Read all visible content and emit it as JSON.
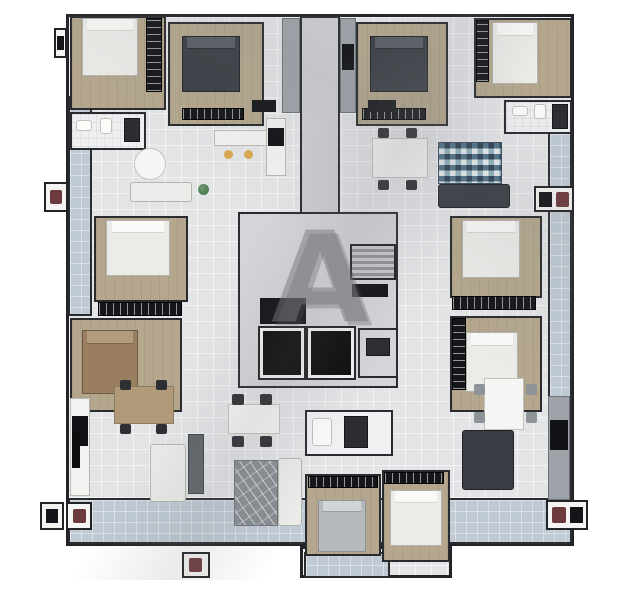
{
  "scene": {
    "type": "apartment-building-floor-plan-3d-render",
    "background": "#ffffff"
  },
  "watermark": {
    "letter": "A"
  },
  "palette": {
    "wall": "#232327",
    "tile_floor": "#e3e4e6",
    "wood_floor": "#b4a78d",
    "balcony_tile": "#bfcad4",
    "core_floor": "#d4d5d8",
    "dark_furniture": "#3c3f45",
    "mosaic_navy": "#2d4254",
    "mosaic_teal": "#8fb2bf",
    "accent_red": "#6c3a3d",
    "stool_yellow": "#d9a84e",
    "plant_green": "#4f7a52"
  },
  "floor_plan": {
    "width": 639,
    "height": 600,
    "elements": [
      {
        "n": "floor-plate",
        "t": "plate",
        "x": 66,
        "y": 14,
        "w": 508,
        "h": 532
      },
      {
        "n": "floor-plate-extension",
        "t": "plate",
        "x": 300,
        "y": 546,
        "w": 152,
        "h": 32
      },
      {
        "n": "balcony-left",
        "t": "balcony",
        "x": 68,
        "y": 96,
        "w": 24,
        "h": 220
      },
      {
        "n": "balcony-right",
        "t": "balcony",
        "x": 548,
        "y": 132,
        "w": 24,
        "h": 366
      },
      {
        "n": "balcony-bottom",
        "t": "balcony",
        "x": 68,
        "y": 498,
        "w": 504,
        "h": 46
      },
      {
        "n": "balcony-extension",
        "t": "balcony",
        "x": 304,
        "y": 552,
        "w": 86,
        "h": 26
      },
      {
        "n": "corridor-top",
        "t": "hallf",
        "x": 300,
        "y": 16,
        "w": 40,
        "h": 198
      },
      {
        "n": "core-floor",
        "t": "coref",
        "x": 238,
        "y": 212,
        "w": 160,
        "h": 176
      },
      {
        "n": "bedroom-top-left",
        "t": "wood",
        "x": 70,
        "y": 16,
        "w": 96,
        "h": 94
      },
      {
        "n": "bedroom-top-left-2",
        "t": "wood",
        "x": 168,
        "y": 22,
        "w": 96,
        "h": 104
      },
      {
        "n": "bedroom-top-center-right",
        "t": "wood",
        "x": 356,
        "y": 22,
        "w": 92,
        "h": 104
      },
      {
        "n": "bedroom-top-right",
        "t": "wood",
        "x": 474,
        "y": 18,
        "w": 98,
        "h": 80
      },
      {
        "n": "bedroom-mid-left-1",
        "t": "wood",
        "x": 94,
        "y": 216,
        "w": 94,
        "h": 86
      },
      {
        "n": "bedroom-mid-left-2",
        "t": "wood",
        "x": 70,
        "y": 318,
        "w": 112,
        "h": 94
      },
      {
        "n": "bedroom-mid-right-1",
        "t": "wood",
        "x": 450,
        "y": 216,
        "w": 92,
        "h": 82
      },
      {
        "n": "bedroom-mid-right-2",
        "t": "wood",
        "x": 450,
        "y": 316,
        "w": 92,
        "h": 96
      },
      {
        "n": "bedroom-bottom-center-1",
        "t": "wood",
        "x": 305,
        "y": 474,
        "w": 76,
        "h": 82
      },
      {
        "n": "bedroom-bottom-center-2",
        "t": "wood",
        "x": 382,
        "y": 470,
        "w": 68,
        "h": 92
      },
      {
        "n": "bathroom-top-left",
        "t": "bathf",
        "x": 70,
        "y": 112,
        "w": 76,
        "h": 38
      },
      {
        "n": "bathroom-top-right",
        "t": "bathf",
        "x": 504,
        "y": 100,
        "w": 68,
        "h": 34
      },
      {
        "n": "laundry-bottom-center",
        "t": "laundry",
        "x": 305,
        "y": 410,
        "w": 88,
        "h": 46
      },
      {
        "n": "kitchen-island-top-left",
        "t": "counter",
        "x": 214,
        "y": 130,
        "w": 54,
        "h": 16
      },
      {
        "n": "kitchen-counter-top-left",
        "t": "counter",
        "x": 266,
        "y": 118,
        "w": 20,
        "h": 58
      },
      {
        "n": "cooktop-top-left",
        "t": "black",
        "x": 268,
        "y": 128,
        "w": 16,
        "h": 18
      },
      {
        "n": "appliance-cabinet-left",
        "t": "cab",
        "x": 282,
        "y": 18,
        "w": 18,
        "h": 95
      },
      {
        "n": "appliance-cabinet-right",
        "t": "cab",
        "x": 340,
        "y": 18,
        "w": 16,
        "h": 95
      },
      {
        "n": "fridge-top-center",
        "t": "black",
        "x": 342,
        "y": 44,
        "w": 12,
        "h": 26
      },
      {
        "n": "kitchen-counter-bottom-left",
        "t": "counter",
        "x": 70,
        "y": 398,
        "w": 20,
        "h": 98
      },
      {
        "n": "cooktop-bottom-left",
        "t": "black",
        "x": 72,
        "y": 416,
        "w": 16,
        "h": 30
      },
      {
        "n": "kitchen-counter-bottom-center",
        "t": "counter-dark",
        "x": 188,
        "y": 434,
        "w": 16,
        "h": 60
      },
      {
        "n": "kitchen-counter-bottom-right",
        "t": "cab",
        "x": 548,
        "y": 396,
        "w": 22,
        "h": 104
      },
      {
        "n": "appliance-bottom-right",
        "t": "black",
        "x": 550,
        "y": 420,
        "w": 18,
        "h": 30
      },
      {
        "n": "wardrobe-top-left",
        "t": "wardrobe-v",
        "x": 146,
        "y": 18,
        "w": 16,
        "h": 74
      },
      {
        "n": "wardrobe-top-left-2",
        "t": "wardrobe",
        "x": 182,
        "y": 108,
        "w": 62,
        "h": 12
      },
      {
        "n": "wardrobe-top-center-right",
        "t": "wardrobe",
        "x": 362,
        "y": 108,
        "w": 64,
        "h": 12
      },
      {
        "n": "wardrobe-top-right",
        "t": "wardrobe-v",
        "x": 476,
        "y": 20,
        "w": 13,
        "h": 62
      },
      {
        "n": "wardrobe-mid-left",
        "t": "wardrobe",
        "x": 98,
        "y": 302,
        "w": 84,
        "h": 14
      },
      {
        "n": "wardrobe-mid-right",
        "t": "wardrobe",
        "x": 452,
        "y": 296,
        "w": 84,
        "h": 14
      },
      {
        "n": "wardrobe-mid-right-2",
        "t": "wardrobe-v",
        "x": 452,
        "y": 318,
        "w": 14,
        "h": 72
      },
      {
        "n": "wardrobe-bottom-center-1",
        "t": "wardrobe",
        "x": 308,
        "y": 476,
        "w": 70,
        "h": 12
      },
      {
        "n": "wardrobe-bottom-center-2",
        "t": "wardrobe",
        "x": 384,
        "y": 472,
        "w": 60,
        "h": 12
      },
      {
        "n": "bed-top-left",
        "t": "bed",
        "x": 82,
        "y": 18,
        "w": 56,
        "h": 58
      },
      {
        "n": "bed-top-left-2",
        "t": "bed-dark",
        "x": 182,
        "y": 36,
        "w": 58,
        "h": 56
      },
      {
        "n": "bed-top-center-right",
        "t": "bed-dark",
        "x": 370,
        "y": 36,
        "w": 58,
        "h": 56
      },
      {
        "n": "bed-top-right",
        "t": "bed",
        "x": 492,
        "y": 22,
        "w": 46,
        "h": 62
      },
      {
        "n": "bed-mid-left-1",
        "t": "bed",
        "x": 106,
        "y": 220,
        "w": 64,
        "h": 56
      },
      {
        "n": "bed-mid-left-2",
        "t": "bed-brown",
        "x": 82,
        "y": 330,
        "w": 56,
        "h": 64
      },
      {
        "n": "bed-mid-right-1",
        "t": "bed",
        "x": 462,
        "y": 220,
        "w": 58,
        "h": 58
      },
      {
        "n": "bed-mid-right-2",
        "t": "bed",
        "x": 466,
        "y": 332,
        "w": 52,
        "h": 60
      },
      {
        "n": "bed-bottom-center-1",
        "t": "bed-gray",
        "x": 318,
        "y": 500,
        "w": 48,
        "h": 52
      },
      {
        "n": "bed-bottom-center-2",
        "t": "bed",
        "x": 390,
        "y": 490,
        "w": 52,
        "h": 56
      },
      {
        "n": "dining-table-top-left",
        "t": "table-round",
        "x": 134,
        "y": 148,
        "w": 32,
        "h": 32
      },
      {
        "n": "sofa-top-left",
        "t": "sofa",
        "x": 130,
        "y": 182,
        "w": 62,
        "h": 20
      },
      {
        "n": "plant-top-left",
        "t": "plant",
        "x": 198,
        "y": 184,
        "w": 11,
        "h": 11
      },
      {
        "n": "stool-1",
        "t": "stool",
        "x": 224,
        "y": 150,
        "w": 9,
        "h": 9
      },
      {
        "n": "stool-2",
        "t": "stool",
        "x": 244,
        "y": 150,
        "w": 9,
        "h": 9
      },
      {
        "n": "dining-table-top-right",
        "t": "table",
        "x": 372,
        "y": 138,
        "w": 56,
        "h": 40
      },
      {
        "n": "chair-tr-1",
        "t": "chair",
        "x": 378,
        "y": 128,
        "w": 11,
        "h": 10
      },
      {
        "n": "chair-tr-2",
        "t": "chair",
        "x": 406,
        "y": 128,
        "w": 11,
        "h": 10
      },
      {
        "n": "chair-tr-3",
        "t": "chair",
        "x": 378,
        "y": 180,
        "w": 11,
        "h": 10
      },
      {
        "n": "chair-tr-4",
        "t": "chair",
        "x": 406,
        "y": 180,
        "w": 11,
        "h": 10
      },
      {
        "n": "mosaic-rug-top-right",
        "t": "rug-mosaic",
        "x": 438,
        "y": 142,
        "w": 64,
        "h": 42
      },
      {
        "n": "sofa-top-right",
        "t": "sofa-dark",
        "x": 438,
        "y": 184,
        "w": 72,
        "h": 24
      },
      {
        "n": "dining-table-bottom-left",
        "t": "table-wood",
        "x": 114,
        "y": 386,
        "w": 60,
        "h": 38
      },
      {
        "n": "chair-bl-1",
        "t": "chair",
        "x": 120,
        "y": 380,
        "w": 11,
        "h": 10
      },
      {
        "n": "chair-bl-2",
        "t": "chair",
        "x": 156,
        "y": 380,
        "w": 11,
        "h": 10
      },
      {
        "n": "chair-bl-3",
        "t": "chair",
        "x": 120,
        "y": 424,
        "w": 11,
        "h": 10
      },
      {
        "n": "chair-bl-4",
        "t": "chair",
        "x": 156,
        "y": 424,
        "w": 11,
        "h": 10
      },
      {
        "n": "tv-bottom-left",
        "t": "tv",
        "x": 72,
        "y": 432,
        "w": 8,
        "h": 36
      },
      {
        "n": "sofa-bottom-left",
        "t": "sofa",
        "x": 150,
        "y": 444,
        "w": 36,
        "h": 58
      },
      {
        "n": "dining-table-bottom-center",
        "t": "table",
        "x": 228,
        "y": 404,
        "w": 52,
        "h": 30
      },
      {
        "n": "chair-bc-1",
        "t": "chair",
        "x": 232,
        "y": 394,
        "w": 12,
        "h": 11
      },
      {
        "n": "chair-bc-2",
        "t": "chair",
        "x": 260,
        "y": 394,
        "w": 12,
        "h": 11
      },
      {
        "n": "chair-bc-3",
        "t": "chair",
        "x": 232,
        "y": 436,
        "w": 12,
        "h": 11
      },
      {
        "n": "chair-bc-4",
        "t": "chair",
        "x": 260,
        "y": 436,
        "w": 12,
        "h": 11
      },
      {
        "n": "rug-bottom-center",
        "t": "rug-gray",
        "x": 234,
        "y": 460,
        "w": 44,
        "h": 66
      },
      {
        "n": "sofa-bottom-center",
        "t": "sofa",
        "x": 278,
        "y": 458,
        "w": 24,
        "h": 68
      },
      {
        "n": "dining-table-bottom-right",
        "t": "table",
        "x": 484,
        "y": 378,
        "w": 40,
        "h": 52
      },
      {
        "n": "chair-br-1",
        "t": "chair-gray",
        "x": 474,
        "y": 384,
        "w": 11,
        "h": 11
      },
      {
        "n": "chair-br-2",
        "t": "chair-gray",
        "x": 526,
        "y": 384,
        "w": 11,
        "h": 11
      },
      {
        "n": "chair-br-3",
        "t": "chair-gray",
        "x": 474,
        "y": 412,
        "w": 11,
        "h": 11
      },
      {
        "n": "chair-br-4",
        "t": "chair-gray",
        "x": 526,
        "y": 412,
        "w": 11,
        "h": 11
      },
      {
        "n": "sofa-bottom-right",
        "t": "sofa-dark",
        "x": 462,
        "y": 430,
        "w": 52,
        "h": 60
      },
      {
        "n": "sink-top-left",
        "t": "fixture",
        "x": 76,
        "y": 120,
        "w": 16,
        "h": 11
      },
      {
        "n": "toilet-top-left",
        "t": "fixture",
        "x": 100,
        "y": 118,
        "w": 12,
        "h": 16
      },
      {
        "n": "shower-top-left",
        "t": "fixture-dark",
        "x": 124,
        "y": 118,
        "w": 16,
        "h": 24
      },
      {
        "n": "sink-top-right",
        "t": "fixture",
        "x": 512,
        "y": 106,
        "w": 16,
        "h": 10
      },
      {
        "n": "toilet-top-right",
        "t": "fixture",
        "x": 534,
        "y": 104,
        "w": 12,
        "h": 15
      },
      {
        "n": "shower-top-right",
        "t": "fixture-dark",
        "x": 552,
        "y": 104,
        "w": 16,
        "h": 25
      },
      {
        "n": "washer-bottom-center",
        "t": "fixture",
        "x": 312,
        "y": 418,
        "w": 20,
        "h": 28
      },
      {
        "n": "closet-bottom-center",
        "t": "fixture-dark",
        "x": 344,
        "y": 416,
        "w": 24,
        "h": 32
      },
      {
        "n": "stairs",
        "t": "stairs",
        "x": 350,
        "y": 244,
        "w": 46,
        "h": 36
      },
      {
        "n": "shaft-duct",
        "t": "black",
        "x": 260,
        "y": 298,
        "w": 46,
        "h": 26
      },
      {
        "n": "core-landing-mat",
        "t": "black",
        "x": 352,
        "y": 284,
        "w": 36,
        "h": 13
      },
      {
        "n": "elevator-1",
        "t": "elevator",
        "x": 260,
        "y": 328,
        "w": 44,
        "h": 50
      },
      {
        "n": "elevator-2",
        "t": "elevator",
        "x": 308,
        "y": 328,
        "w": 46,
        "h": 50
      },
      {
        "n": "core-lobby",
        "t": "coref",
        "x": 358,
        "y": 328,
        "w": 40,
        "h": 50
      },
      {
        "n": "core-lobby-cabinet",
        "t": "fixture-dark",
        "x": 366,
        "y": 338,
        "w": 24,
        "h": 18
      },
      {
        "n": "entry-mat-left",
        "t": "mat",
        "x": 252,
        "y": 100,
        "w": 24,
        "h": 12
      },
      {
        "n": "entry-mat-right",
        "t": "mat",
        "x": 368,
        "y": 100,
        "w": 28,
        "h": 12
      },
      {
        "n": "ac-ledge-left",
        "t": "ledge",
        "x": 44,
        "y": 182,
        "w": 24,
        "h": 30
      },
      {
        "n": "ac-unit-left",
        "t": "obj-red",
        "x": 50,
        "y": 190,
        "w": 12,
        "h": 14
      },
      {
        "n": "ac-ledge-top-left",
        "t": "ledge",
        "x": 54,
        "y": 28,
        "w": 13,
        "h": 30
      },
      {
        "n": "ac-unit-top-left",
        "t": "obj-black",
        "x": 57,
        "y": 36,
        "w": 7,
        "h": 14
      },
      {
        "n": "ac-ledge-bottom-left-1",
        "t": "ledge",
        "x": 40,
        "y": 502,
        "w": 24,
        "h": 28
      },
      {
        "n": "ac-unit-bottom-left-1",
        "t": "obj-black",
        "x": 46,
        "y": 509,
        "w": 12,
        "h": 14
      },
      {
        "n": "ac-ledge-bottom-left-2",
        "t": "ledge",
        "x": 66,
        "y": 502,
        "w": 26,
        "h": 28
      },
      {
        "n": "ac-unit-bottom-left-2",
        "t": "obj-red",
        "x": 73,
        "y": 509,
        "w": 13,
        "h": 14
      },
      {
        "n": "ac-ledge-right",
        "t": "ledge",
        "x": 534,
        "y": 186,
        "w": 40,
        "h": 26
      },
      {
        "n": "ac-unit-right-1",
        "t": "obj-black",
        "x": 539,
        "y": 192,
        "w": 13,
        "h": 15
      },
      {
        "n": "ac-unit-right-2",
        "t": "obj-red",
        "x": 556,
        "y": 192,
        "w": 13,
        "h": 15
      },
      {
        "n": "ac-ledge-bottom-right",
        "t": "ledge",
        "x": 546,
        "y": 500,
        "w": 42,
        "h": 30
      },
      {
        "n": "ac-unit-bottom-right-1",
        "t": "obj-red",
        "x": 552,
        "y": 507,
        "w": 14,
        "h": 16
      },
      {
        "n": "ac-unit-bottom-right-2",
        "t": "obj-black",
        "x": 570,
        "y": 507,
        "w": 13,
        "h": 16
      },
      {
        "n": "ac-ledge-bottom-center",
        "t": "ledge",
        "x": 182,
        "y": 552,
        "w": 28,
        "h": 26
      },
      {
        "n": "ac-unit-bottom-center",
        "t": "obj-red",
        "x": 189,
        "y": 558,
        "w": 13,
        "h": 14
      },
      {
        "n": "sun-shadow-overlay",
        "t": "overlay",
        "x": 66,
        "y": 14,
        "w": 508,
        "h": 566
      },
      {
        "n": "watermark-letter",
        "t": "watermark",
        "x": 238,
        "y": 205,
        "w": 164,
        "h": 145,
        "bind": "watermark.letter"
      }
    ]
  }
}
